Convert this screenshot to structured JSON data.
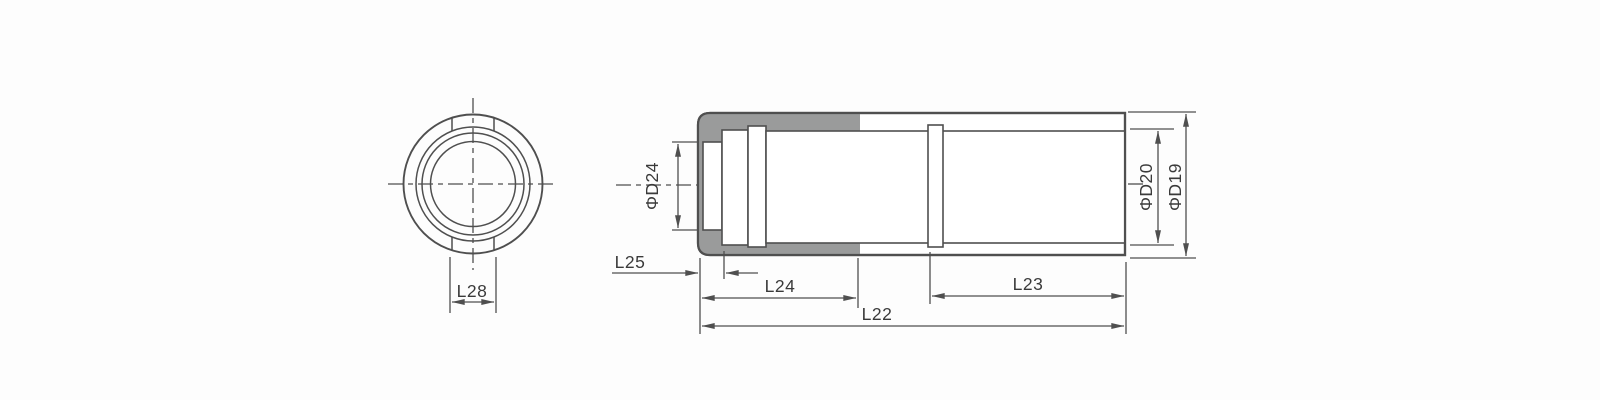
{
  "drawing": {
    "kind": "nozzle-technical-drawing",
    "labels": {
      "l28": "L28",
      "l25": "L25",
      "l24": "L24",
      "l23": "L23",
      "l22": "L22",
      "d24": "ΦD24",
      "d20": "ΦD20",
      "d19": "ΦD19"
    },
    "colors": {
      "background": "#fdfdfd",
      "line": "#4f4f4f",
      "shell_fill": "#9a9b9b",
      "text": "#3a3a3a"
    }
  }
}
